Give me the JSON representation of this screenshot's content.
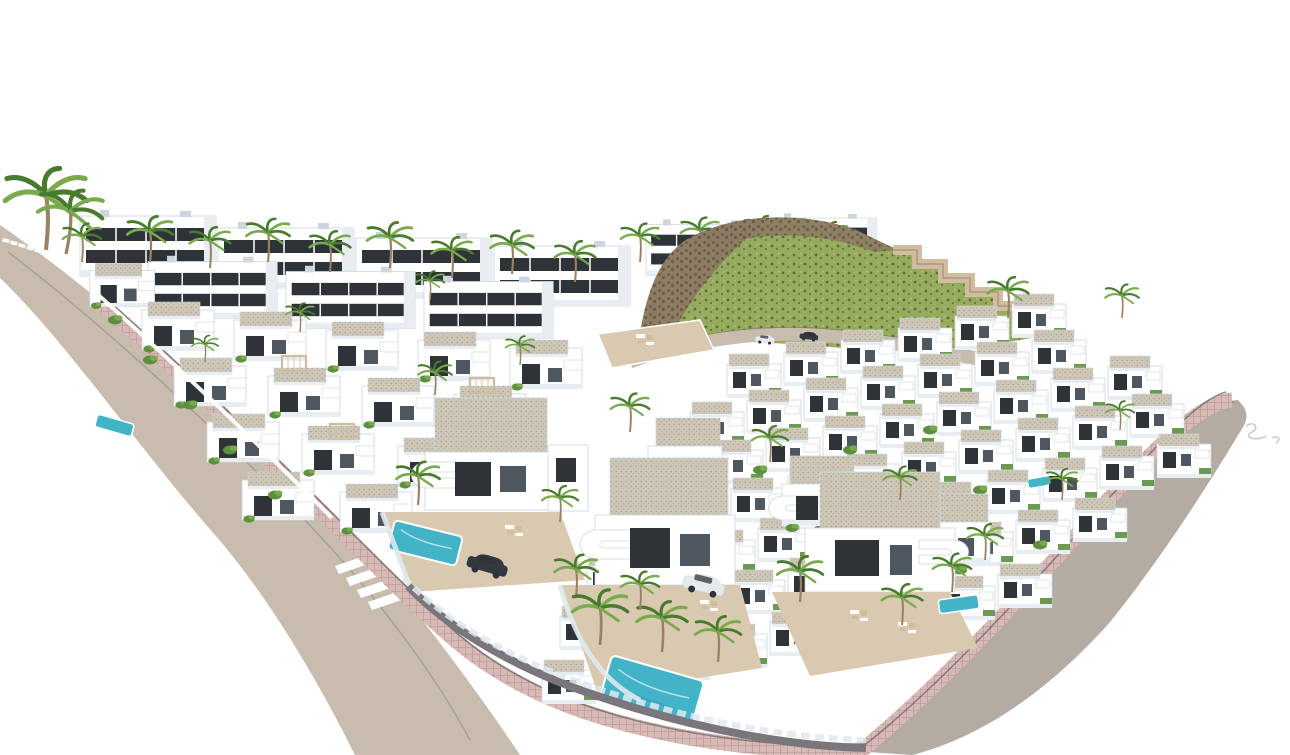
{
  "meta": {
    "description": "Aerial 3D architectural rendering of a hillside residential development: rows of white modern villas and terraced townhouses with gravel flat roofs, palm trees, turquoise swimming pools, beige terraces, a rocky green hillside with a stepped retaining wall, curving tan roads edged with pink pavements, zebra crosswalks and a few parked cars, all on a plain white background."
  },
  "colors": {
    "background": "#ffffff",
    "road_tan": "#c8bcae",
    "road_gray": "#b4aba2",
    "road_edge": "#77716a",
    "lane_line": "#a39a8e",
    "sidewalk_pink": "#d7b9b6",
    "sidewalk_pink_dark": "#c19d9a",
    "curb_dark": "#5d5a60",
    "villa_white": "#ffffff",
    "villa_shade": "#e8edf2",
    "villa_shade_dark": "#ccd6de",
    "window_dark": "#2e3338",
    "window_glass": "#4e575f",
    "roof_gravel": "#cec7b8",
    "roof_gravel_dot": "#a49c8c",
    "terrace_beige": "#d9c9b1",
    "garden_wall": "#7a777c",
    "glass_fence": "#dfe9ed",
    "palm_trunk": "#9a8165",
    "palm_green": "#497b2f",
    "palm_green_light": "#79aa4c",
    "bush_green": "#5c8f3e",
    "hill_green": "#96ab5e",
    "hill_green_dark": "#5a7433",
    "hill_rock": "#8c7b64",
    "hill_rock_dark": "#635441",
    "wall_steps_tan": "#d0bc9e",
    "pool_blue": "#43b4c8",
    "pool_blue_deep": "#2b9cb2",
    "car_dark": "#34373c",
    "car_white": "#e7e9ea",
    "squiggle_gray": "#c7c3bd"
  },
  "scene": {
    "features": {
      "back_villa_blocks": 9,
      "hillsides": 1,
      "townhouse_rows": 7,
      "foreground_villas": 3,
      "swimming_pools": 7,
      "palm_trees": 40,
      "cars": 4,
      "zebra_crosswalks": 2
    }
  }
}
